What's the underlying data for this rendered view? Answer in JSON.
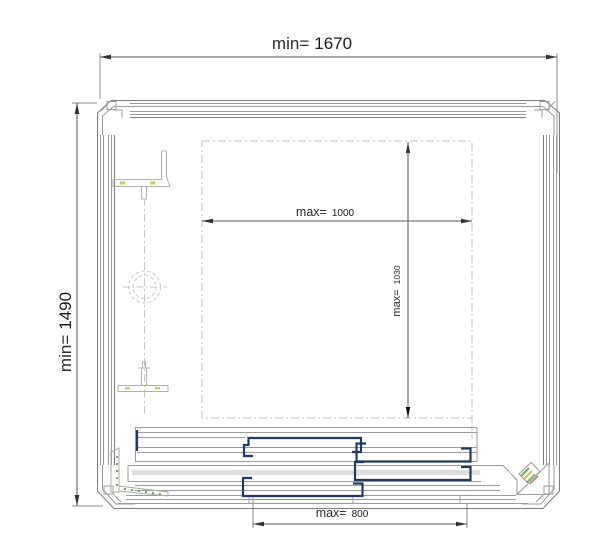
{
  "drawing": {
    "labels": {
      "overall_width": {
        "prefix": "min=",
        "value": "1670"
      },
      "overall_height": {
        "prefix": "min=",
        "value": "1490"
      },
      "opening_width": {
        "prefix": "max=",
        "value": "1000"
      },
      "opening_height": {
        "prefix": "max=",
        "value": "1030"
      },
      "panel_width": {
        "prefix": "max=",
        "value": "800"
      }
    },
    "colors": {
      "profile_line": "#9b9b9b",
      "dimension_line": "#555555",
      "text": "#1a1a1a",
      "panel_navy": "#1e3a64",
      "dash_line": "#c2c2c2",
      "track_fill": "#dedede",
      "accent_green": "#6fae4e",
      "accent_yellow": "#c9c04c",
      "accent_red": "#c0504d"
    }
  }
}
